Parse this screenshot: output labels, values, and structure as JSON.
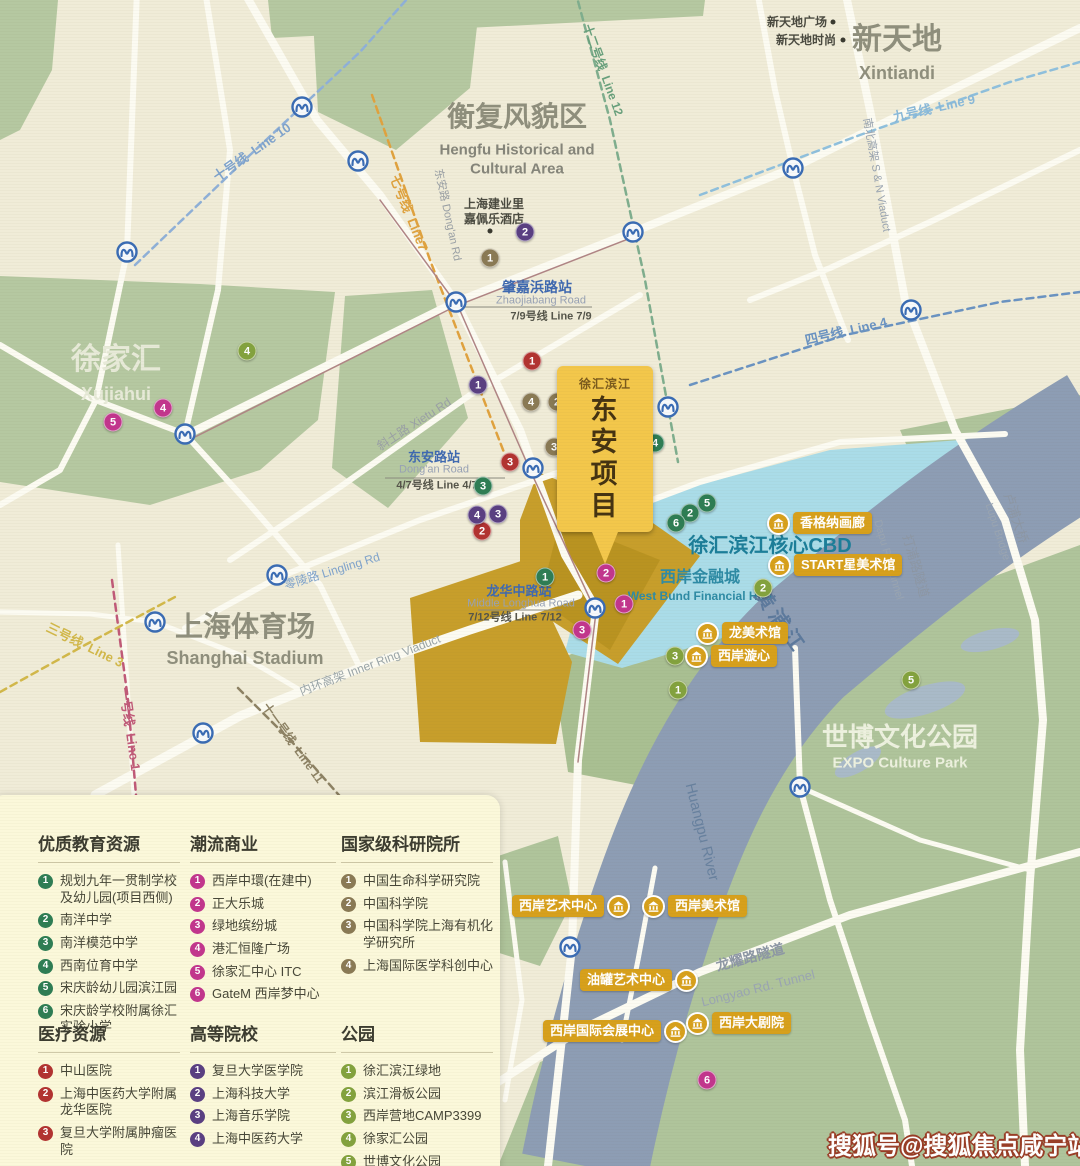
{
  "colors": {
    "education": "#2e7d54",
    "commercial": "#c2368d",
    "research": "#8a7a55",
    "medical": "#b23331",
    "university": "#5a3f82",
    "park": "#83a23e",
    "badge_gold": "#d7a01c",
    "metro_blue": "#3a6cb4",
    "cbd_blue": "#aadce8",
    "project_gold": "#c79e2b",
    "water": "#8d9db4",
    "green": "#b5c8a1",
    "map_bg": "#f0ecd8",
    "legend_bg": "#fbf8da"
  },
  "map": {
    "callout": {
      "small": "徐汇滨江",
      "big": "东安项目"
    },
    "watermark": "搜狐号@搜狐焦点咸宁站",
    "labels": [
      {
        "id": "xintiandi-cn",
        "t": "新天地",
        "x": 897,
        "y": 40,
        "s": 30,
        "c": "#8f8f7d",
        "b": 1
      },
      {
        "id": "xintiandi-en",
        "t": "Xintiandi",
        "x": 897,
        "y": 73,
        "s": 18,
        "c": "#8f8f7d",
        "b": 1
      },
      {
        "id": "hengfu-cn",
        "t": "衡复风貌区",
        "x": 517,
        "y": 117,
        "s": 28,
        "c": "#8f8f7d",
        "b": 1
      },
      {
        "id": "hengfu-en1",
        "t": "Hengfu Historical and",
        "x": 517,
        "y": 150,
        "s": 15,
        "c": "#85857a",
        "b": 1
      },
      {
        "id": "hengfu-en2",
        "t": "Cultural Area",
        "x": 517,
        "y": 169,
        "s": 15,
        "c": "#85857a",
        "b": 1
      },
      {
        "id": "xujiahui-cn",
        "t": "徐家汇",
        "x": 116,
        "y": 360,
        "s": 30,
        "c": "#e7ead8",
        "b": 1
      },
      {
        "id": "xujiahui-en",
        "t": "Xujiahui",
        "x": 116,
        "y": 394,
        "s": 18,
        "c": "#e7ead8",
        "b": 1
      },
      {
        "id": "stadium-cn",
        "t": "上海体育场",
        "x": 245,
        "y": 627,
        "s": 28,
        "c": "#8f8f7d",
        "b": 1
      },
      {
        "id": "stadium-en",
        "t": "Shanghai Stadium",
        "x": 245,
        "y": 658,
        "s": 18,
        "c": "#8f8f7d",
        "b": 1
      },
      {
        "id": "expo-cn",
        "t": "世博文化公园",
        "x": 900,
        "y": 737,
        "s": 26,
        "c": "#edf1df",
        "b": 1
      },
      {
        "id": "expo-en",
        "t": "EXPO Culture Park",
        "x": 900,
        "y": 763,
        "s": 15,
        "c": "#edf1df",
        "b": 1
      },
      {
        "id": "cbd-label",
        "t": "徐汇滨江核心CBD",
        "x": 770,
        "y": 546,
        "s": 20,
        "c": "#1c7e99",
        "b": 1
      },
      {
        "id": "westbund-cn",
        "t": "西岸金融城",
        "x": 700,
        "y": 578,
        "s": 16,
        "c": "#2e8ba5",
        "b": 1
      },
      {
        "id": "westbund-en",
        "t": "West Bund Financial Hub",
        "x": 700,
        "y": 596,
        "s": 12,
        "c": "#2e8ba5",
        "b": 1
      },
      {
        "id": "xintiandi-plaza",
        "t": "新天地广场",
        "x": 797,
        "y": 22,
        "s": 12,
        "c": "#4a4a40",
        "b": 1
      },
      {
        "id": "xintiandi-style",
        "t": "新天地时尚",
        "x": 806,
        "y": 40,
        "s": 12,
        "c": "#4a4a40",
        "b": 1
      },
      {
        "id": "capella-1",
        "t": "上海建业里",
        "x": 494,
        "y": 204,
        "s": 12,
        "c": "#4a4a40",
        "b": 1
      },
      {
        "id": "capella-2",
        "t": "嘉佩乐酒店",
        "x": 494,
        "y": 219,
        "s": 12,
        "c": "#4a4a40",
        "b": 1
      },
      {
        "id": "zhaojiabang-cn",
        "t": "肇嘉浜路站",
        "x": 537,
        "y": 287,
        "s": 14,
        "c": "#3f69b0",
        "b": 1
      },
      {
        "id": "zhaojiabang-en",
        "t": "Zhaojiabang Road",
        "x": 541,
        "y": 301,
        "s": 11,
        "c": "#98a2b5"
      },
      {
        "id": "zhaojiabang-line",
        "t": "7/9号线 Line 7/9",
        "x": 551,
        "y": 317,
        "s": 11,
        "c": "#55554a",
        "b": 1
      },
      {
        "id": "dongan-st-cn",
        "t": "东安路站",
        "x": 434,
        "y": 457,
        "s": 13,
        "c": "#3f69b0",
        "b": 1
      },
      {
        "id": "dongan-st-en",
        "t": "Dong'an Road",
        "x": 434,
        "y": 470,
        "s": 11,
        "c": "#98a2b5"
      },
      {
        "id": "dongan-st-line",
        "t": "4/7号线 Line 4/7",
        "x": 437,
        "y": 486,
        "s": 11,
        "c": "#55554a",
        "b": 1
      },
      {
        "id": "longhua-cn",
        "t": "龙华中路站",
        "x": 519,
        "y": 591,
        "s": 13,
        "c": "#3f69b0",
        "b": 1
      },
      {
        "id": "longhua-en",
        "t": "Middle Longhua Road",
        "x": 521,
        "y": 604,
        "s": 11,
        "c": "#98a2b5"
      },
      {
        "id": "longhua-line",
        "t": "7/12号线 Line 7/12",
        "x": 515,
        "y": 618,
        "s": 11,
        "c": "#55554a",
        "b": 1
      },
      {
        "id": "line10",
        "t": "十号线  Line 10",
        "x": 252,
        "y": 152,
        "s": 13,
        "c": "#7fa3cc",
        "b": 1,
        "r": -35
      },
      {
        "id": "line7",
        "t": "七号线  Line7",
        "x": 409,
        "y": 213,
        "s": 13,
        "c": "#dfa23e",
        "b": 1,
        "r": 68
      },
      {
        "id": "dongan-rd",
        "t": "东安路 Dong'an Rd",
        "x": 447,
        "y": 215,
        "s": 11,
        "c": "#9aa0a5",
        "r": 78
      },
      {
        "id": "line12",
        "t": "十二号线  Line 12",
        "x": 603,
        "y": 70,
        "s": 12,
        "c": "#68a07c",
        "b": 1,
        "r": 70
      },
      {
        "id": "line9",
        "t": "九号线  Line 9",
        "x": 934,
        "y": 108,
        "s": 13,
        "c": "#8ab9d9",
        "b": 1,
        "r": -13
      },
      {
        "id": "sn-viaduct",
        "t": "南北高架 S & N Viaduct",
        "x": 876,
        "y": 175,
        "s": 11,
        "c": "#98a3b0",
        "r": 80
      },
      {
        "id": "line4",
        "t": "四号线  Line 4",
        "x": 846,
        "y": 331,
        "s": 13,
        "c": "#6a93c2",
        "b": 1,
        "r": -13
      },
      {
        "id": "line3",
        "t": "三号线  Line 3",
        "x": 85,
        "y": 645,
        "s": 13,
        "c": "#d2b84a",
        "b": 1,
        "r": 26
      },
      {
        "id": "line1",
        "t": "一号线  Line 1",
        "x": 130,
        "y": 729,
        "s": 13,
        "c": "#c05a78",
        "b": 1,
        "r": 82
      },
      {
        "id": "line11",
        "t": "十一号线  Line 11",
        "x": 293,
        "y": 743,
        "s": 12,
        "c": "#8d8264",
        "b": 1,
        "r": 54
      },
      {
        "id": "lingling-rd",
        "t": "零陵路 Lingling Rd",
        "x": 332,
        "y": 571,
        "s": 12,
        "c": "#7fa3cc",
        "r": -17
      },
      {
        "id": "xietu-rd",
        "t": "斜土路 Xietu Rd",
        "x": 414,
        "y": 424,
        "s": 12,
        "c": "#9aa0a5",
        "r": -33
      },
      {
        "id": "inner-ring",
        "t": "内环高架 Inner Ring Viaduct",
        "x": 370,
        "y": 665,
        "s": 12,
        "c": "#9aa5a8",
        "r": -21
      },
      {
        "id": "longyao-cn",
        "t": "龙耀路隧道",
        "x": 750,
        "y": 957,
        "s": 14,
        "c": "#8d97a5",
        "b": 1,
        "r": -15
      },
      {
        "id": "longyao-en",
        "t": "Longyao Rd. Tunnel",
        "x": 758,
        "y": 988,
        "s": 13,
        "c": "#9aa5b2",
        "r": -14
      },
      {
        "id": "dapu-en",
        "t": "Dapu Rd. Tunnel",
        "x": 888,
        "y": 560,
        "s": 11,
        "c": "#9aa5b2",
        "r": 74
      },
      {
        "id": "dapu-cn",
        "t": "打浦路隧道",
        "x": 916,
        "y": 566,
        "s": 13,
        "c": "#8d97a5",
        "r": 74
      },
      {
        "id": "lupu-en",
        "t": "Lupu Bridge",
        "x": 997,
        "y": 532,
        "s": 11,
        "c": "#9aa5b2",
        "r": 72
      },
      {
        "id": "lupu-cn",
        "t": "卢浦大桥",
        "x": 1016,
        "y": 518,
        "s": 13,
        "c": "#8d97a5",
        "r": 72
      },
      {
        "id": "huangpu-cn",
        "t": "黄浦江",
        "x": 780,
        "y": 622,
        "s": 20,
        "c": "#5d7a9d",
        "b": 1,
        "r": 55,
        "ls": 5
      },
      {
        "id": "huangpu-en",
        "t": "Huangpu River",
        "x": 702,
        "y": 832,
        "s": 15,
        "c": "#68819f",
        "r": 76
      }
    ],
    "dots": [
      {
        "x": 833,
        "y": 22
      },
      {
        "x": 843,
        "y": 40
      },
      {
        "x": 490,
        "y": 231
      }
    ],
    "markers": [
      {
        "cat": "education",
        "n": "1",
        "x": 545,
        "y": 577
      },
      {
        "cat": "education",
        "n": "2",
        "x": 690,
        "y": 513
      },
      {
        "cat": "education",
        "n": "3",
        "x": 483,
        "y": 486
      },
      {
        "cat": "education",
        "n": "4",
        "x": 655,
        "y": 443
      },
      {
        "cat": "education",
        "n": "5",
        "x": 707,
        "y": 503
      },
      {
        "cat": "education",
        "n": "6",
        "x": 676,
        "y": 523
      },
      {
        "cat": "commercial",
        "n": "1",
        "x": 624,
        "y": 604
      },
      {
        "cat": "commercial",
        "n": "2",
        "x": 606,
        "y": 573
      },
      {
        "cat": "commercial",
        "n": "3",
        "x": 582,
        "y": 630
      },
      {
        "cat": "commercial",
        "n": "4",
        "x": 163,
        "y": 408
      },
      {
        "cat": "commercial",
        "n": "5",
        "x": 113,
        "y": 422
      },
      {
        "cat": "commercial",
        "n": "6",
        "x": 707,
        "y": 1080
      },
      {
        "cat": "research",
        "n": "1",
        "x": 490,
        "y": 258
      },
      {
        "cat": "research",
        "n": "2",
        "x": 557,
        "y": 402
      },
      {
        "cat": "research",
        "n": "3",
        "x": 554,
        "y": 447
      },
      {
        "cat": "research",
        "n": "4",
        "x": 531,
        "y": 402
      },
      {
        "cat": "medical",
        "n": "1",
        "x": 532,
        "y": 361
      },
      {
        "cat": "medical",
        "n": "2",
        "x": 482,
        "y": 531
      },
      {
        "cat": "medical",
        "n": "3",
        "x": 510,
        "y": 462
      },
      {
        "cat": "university",
        "n": "1",
        "x": 478,
        "y": 385
      },
      {
        "cat": "university",
        "n": "2",
        "x": 525,
        "y": 232
      },
      {
        "cat": "university",
        "n": "3",
        "x": 498,
        "y": 514
      },
      {
        "cat": "university",
        "n": "4",
        "x": 477,
        "y": 515
      },
      {
        "cat": "park",
        "n": "1",
        "x": 678,
        "y": 690
      },
      {
        "cat": "park",
        "n": "2",
        "x": 763,
        "y": 588
      },
      {
        "cat": "park",
        "n": "3",
        "x": 675,
        "y": 656
      },
      {
        "cat": "park",
        "n": "4",
        "x": 247,
        "y": 351
      },
      {
        "cat": "park",
        "n": "5",
        "x": 911,
        "y": 680
      }
    ],
    "metro_icons": [
      {
        "x": 302,
        "y": 107
      },
      {
        "x": 358,
        "y": 161
      },
      {
        "x": 127,
        "y": 252
      },
      {
        "x": 456,
        "y": 302
      },
      {
        "x": 633,
        "y": 232
      },
      {
        "x": 793,
        "y": 168
      },
      {
        "x": 911,
        "y": 310
      },
      {
        "x": 185,
        "y": 434
      },
      {
        "x": 533,
        "y": 468
      },
      {
        "x": 668,
        "y": 407
      },
      {
        "x": 595,
        "y": 608
      },
      {
        "x": 277,
        "y": 575
      },
      {
        "x": 155,
        "y": 622
      },
      {
        "x": 203,
        "y": 733
      },
      {
        "x": 570,
        "y": 947
      },
      {
        "x": 800,
        "y": 787
      }
    ],
    "badges": [
      {
        "label": "香格纳画廊",
        "x": 767,
        "y": 523,
        "side": "left"
      },
      {
        "label": "START星美术馆",
        "x": 768,
        "y": 565,
        "side": "left"
      },
      {
        "label": "龙美术馆",
        "x": 696,
        "y": 633,
        "side": "left"
      },
      {
        "label": "西岸漩心",
        "x": 685,
        "y": 656,
        "side": "left"
      },
      {
        "label": "西岸艺术中心",
        "x": 512,
        "y": 906,
        "side": "right"
      },
      {
        "label": "西岸美术馆",
        "x": 642,
        "y": 906,
        "side": "left"
      },
      {
        "label": "油罐艺术中心",
        "x": 580,
        "y": 980,
        "side": "right"
      },
      {
        "label": "西岸国际会展中心",
        "x": 543,
        "y": 1031,
        "side": "right"
      },
      {
        "label": "西岸大剧院",
        "x": 686,
        "y": 1023,
        "side": "left"
      }
    ]
  },
  "legend": {
    "groups": [
      {
        "cat": "education",
        "title": "优质教育资源",
        "x": 48,
        "y": 35,
        "w": 142,
        "items": [
          "规划九年一贯制学校及幼儿园(项目西侧)",
          "南洋中学",
          "南洋模范中学",
          "西南位育中学",
          "宋庆龄幼儿园滨江园",
          "宋庆龄学校附属徐汇实验小学"
        ]
      },
      {
        "cat": "commercial",
        "title": "潮流商业",
        "x": 200,
        "y": 35,
        "w": 146,
        "items": [
          "西岸中環(在建中)",
          "正大乐城",
          "绿地缤纷城",
          "港汇恒隆广场",
          "徐家汇中心 ITC",
          "GateM 西岸梦中心"
        ]
      },
      {
        "cat": "research",
        "title": "国家级科研院所",
        "x": 351,
        "y": 35,
        "w": 152,
        "items": [
          "中国生命科学研究院",
          "中国科学院",
          "中国科学院上海有机化学研究所",
          "上海国际医学科创中心"
        ]
      },
      {
        "cat": "medical",
        "title": "医疗资源",
        "x": 48,
        "y": 225,
        "w": 142,
        "items": [
          "中山医院",
          "上海中医药大学附属龙华医院",
          "复旦大学附属肿瘤医院"
        ]
      },
      {
        "cat": "university",
        "title": "高等院校",
        "x": 200,
        "y": 225,
        "w": 146,
        "items": [
          "复旦大学医学院",
          "上海科技大学",
          "上海音乐学院",
          "上海中医药大学"
        ]
      },
      {
        "cat": "park",
        "title": "公园",
        "x": 351,
        "y": 225,
        "w": 152,
        "items": [
          "徐汇滨江绿地",
          "滨江滑板公园",
          "西岸营地CAMP3399",
          "徐家汇公园",
          "世博文化公园"
        ]
      }
    ]
  }
}
